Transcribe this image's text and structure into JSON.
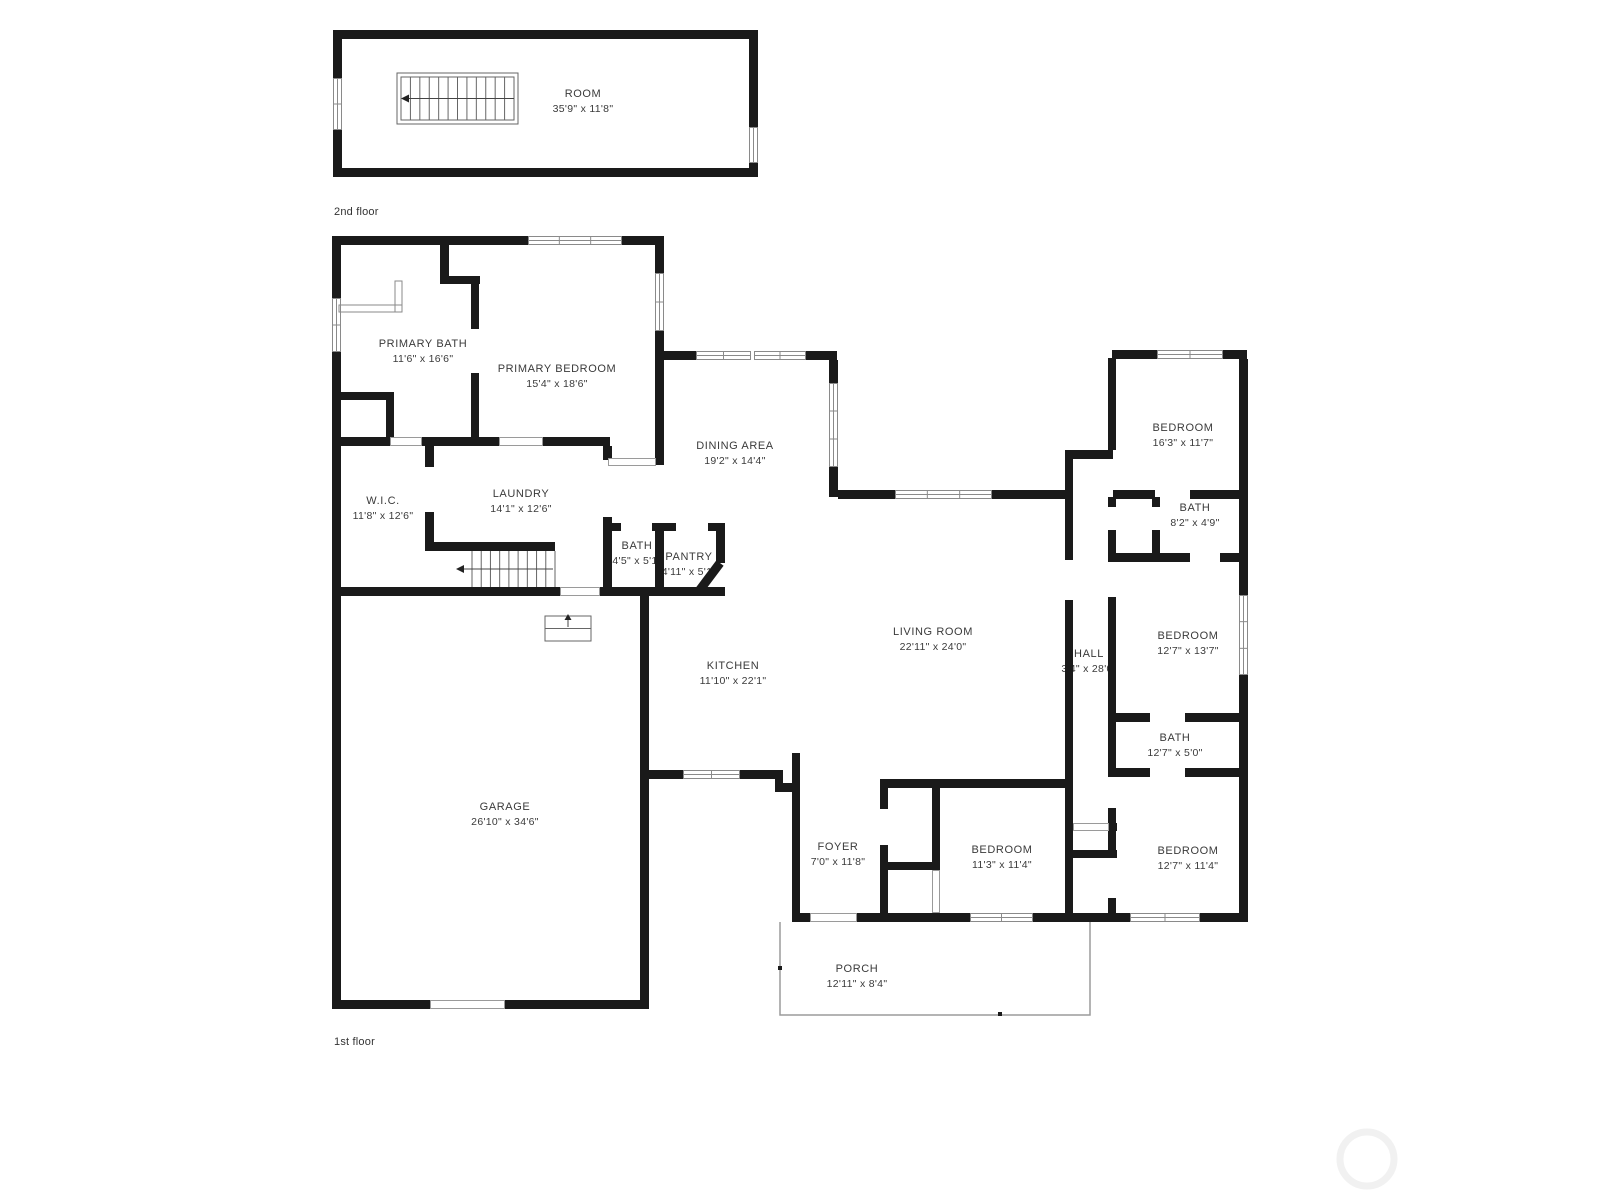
{
  "colors": {
    "wall": "#1a1a1a",
    "window_line": "#8a8a8a",
    "opening_line": "#9a9a9a",
    "label_text": "#3a3a3a",
    "porch_line": "#9b9b9b",
    "watermark": "#f1f1f1"
  },
  "floors": [
    {
      "label": "2nd floor",
      "rooms": [
        {
          "name": "ROOM",
          "dims": "35'9\" x 11'8\""
        }
      ]
    },
    {
      "label": "1st floor",
      "rooms": [
        {
          "name": "PRIMARY BATH",
          "dims": "11'6\" x 16'6\""
        },
        {
          "name": "PRIMARY BEDROOM",
          "dims": "15'4\" x 18'6\""
        },
        {
          "name": "DINING AREA",
          "dims": "19'2\" x 14'4\""
        },
        {
          "name": "W.I.C.",
          "dims": "11'8\" x 12'6\""
        },
        {
          "name": "LAUNDRY",
          "dims": "14'1\" x 12'6\""
        },
        {
          "name": "BATH",
          "dims": "4'5\" x 5'1\""
        },
        {
          "name": "PANTRY",
          "dims": "4'11\" x 5'1\""
        },
        {
          "name": "KITCHEN",
          "dims": "11'10\" x 22'1\""
        },
        {
          "name": "LIVING ROOM",
          "dims": "22'11\" x 24'0\""
        },
        {
          "name": "HALL",
          "dims": "3'4\" x 28'0\""
        },
        {
          "name": "BEDROOM",
          "dims": "16'3\" x 11'7\""
        },
        {
          "name": "BATH",
          "dims": "8'2\" x 4'9\""
        },
        {
          "name": "BEDROOM",
          "dims": "12'7\" x 13'7\""
        },
        {
          "name": "BATH",
          "dims": "12'7\" x 5'0\""
        },
        {
          "name": "BEDROOM",
          "dims": "12'7\" x 11'4\""
        },
        {
          "name": "BEDROOM",
          "dims": "11'3\" x 11'4\""
        },
        {
          "name": "FOYER",
          "dims": "7'0\" x 11'8\""
        },
        {
          "name": "GARAGE",
          "dims": "26'10\" x 34'6\""
        },
        {
          "name": "PORCH",
          "dims": "12'11\" x 8'4\""
        }
      ]
    }
  ]
}
